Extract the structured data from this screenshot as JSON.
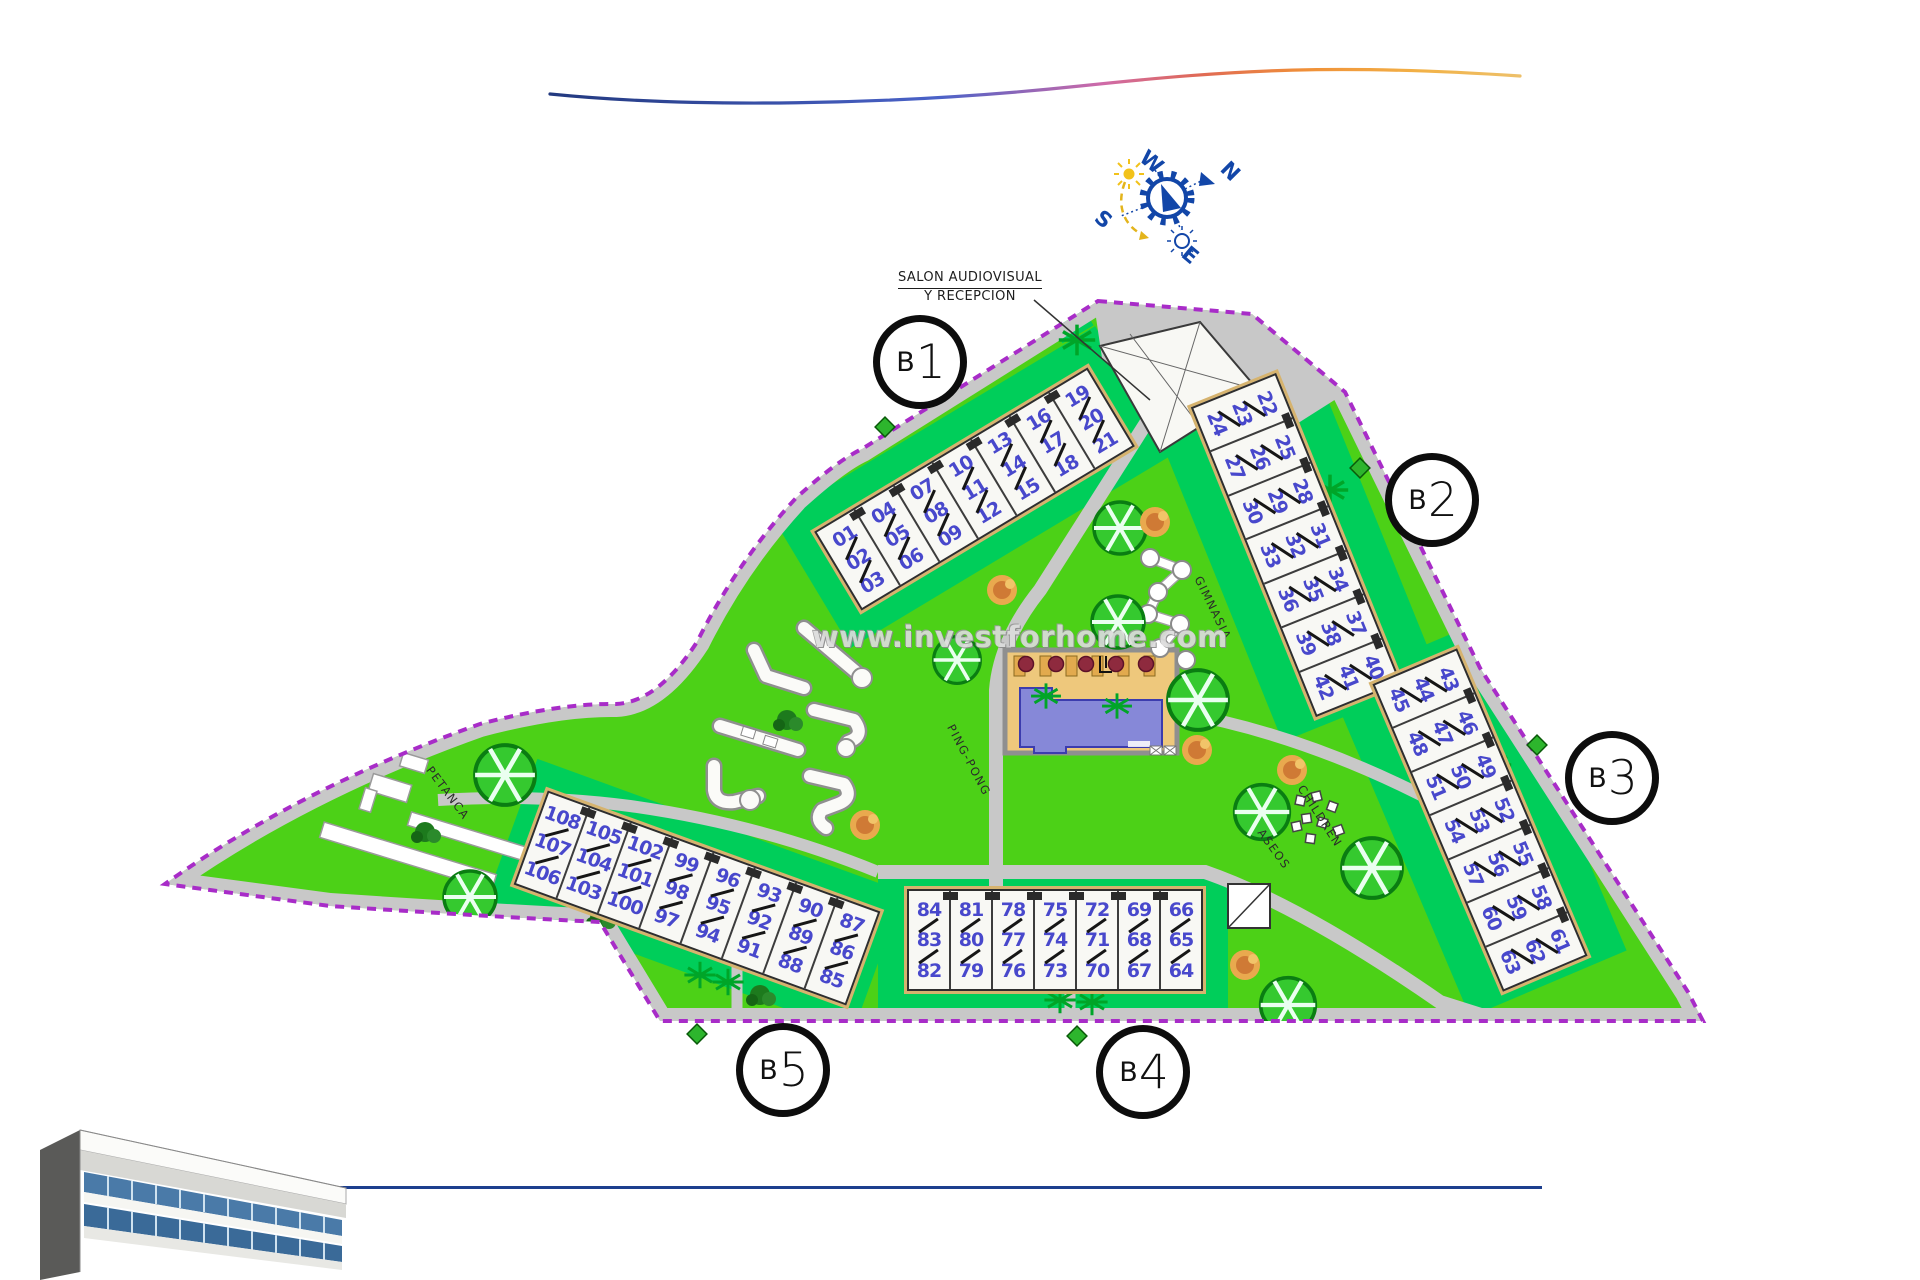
{
  "page": {
    "watermark": "www.investforhome.com"
  },
  "plan": {
    "reception_label": {
      "line1": "SALON AUDIOVISUAL",
      "line2": "Y RECEPCION"
    },
    "compass": {
      "north": "N",
      "south": "S",
      "east": "E",
      "west": "W"
    },
    "labels": {
      "petanca": "PETANCA",
      "gym": "GIMNASIA",
      "ping_pong": "PING-PONG",
      "children": "CHILDREN",
      "toilets": "ASEOS"
    },
    "blocks": [
      {
        "id": "b1",
        "prefix": "B",
        "number": "1",
        "trios": [
          [
            "01",
            "02",
            "03"
          ],
          [
            "04",
            "05",
            "06"
          ],
          [
            "07",
            "08",
            "09"
          ],
          [
            "10",
            "11",
            "12"
          ],
          [
            "13",
            "14",
            "15"
          ],
          [
            "16",
            "17",
            "18"
          ],
          [
            "19",
            "20",
            "21"
          ]
        ]
      },
      {
        "id": "b2",
        "prefix": "B",
        "number": "2",
        "trios": [
          [
            "22",
            "23",
            "24"
          ],
          [
            "25",
            "26",
            "27"
          ],
          [
            "28",
            "29",
            "30"
          ],
          [
            "31",
            "32",
            "33"
          ],
          [
            "34",
            "35",
            "36"
          ],
          [
            "37",
            "38",
            "39"
          ],
          [
            "40",
            "41",
            "42"
          ]
        ]
      },
      {
        "id": "b3",
        "prefix": "B",
        "number": "3",
        "trios": [
          [
            "43",
            "44",
            "45"
          ],
          [
            "46",
            "47",
            "48"
          ],
          [
            "49",
            "50",
            "51"
          ],
          [
            "52",
            "53",
            "54"
          ],
          [
            "55",
            "56",
            "57"
          ],
          [
            "58",
            "59",
            "60"
          ],
          [
            "61",
            "62",
            "63"
          ]
        ]
      },
      {
        "id": "b4",
        "prefix": "B",
        "number": "4",
        "trios": [
          [
            "84",
            "83",
            "82"
          ],
          [
            "81",
            "80",
            "79"
          ],
          [
            "78",
            "77",
            "76"
          ],
          [
            "75",
            "74",
            "73"
          ],
          [
            "72",
            "71",
            "70"
          ],
          [
            "69",
            "68",
            "67"
          ],
          [
            "66",
            "65",
            "64"
          ]
        ]
      },
      {
        "id": "b5",
        "prefix": "B",
        "number": "5",
        "trios": [
          [
            "108",
            "107",
            "106"
          ],
          [
            "105",
            "104",
            "103"
          ],
          [
            "102",
            "101",
            "100"
          ],
          [
            "99",
            "98",
            "97"
          ],
          [
            "96",
            "95",
            "94"
          ],
          [
            "93",
            "92",
            "91"
          ],
          [
            "90",
            "89",
            "88"
          ],
          [
            "87",
            "86",
            "85"
          ]
        ]
      }
    ],
    "colors": {
      "lawn": "#4cd117",
      "garden": "#00ce5a",
      "road": "#c8c8c8",
      "boundary": "#a82cc8",
      "unit_number": "#4848cc",
      "pool_deck": "#eec87c",
      "pool_water": "#8688d8",
      "tree": "#35c92f",
      "tree_edge": "#0a7d12",
      "navy_line": "#1d3f8e",
      "accent": "#1246a8"
    }
  }
}
